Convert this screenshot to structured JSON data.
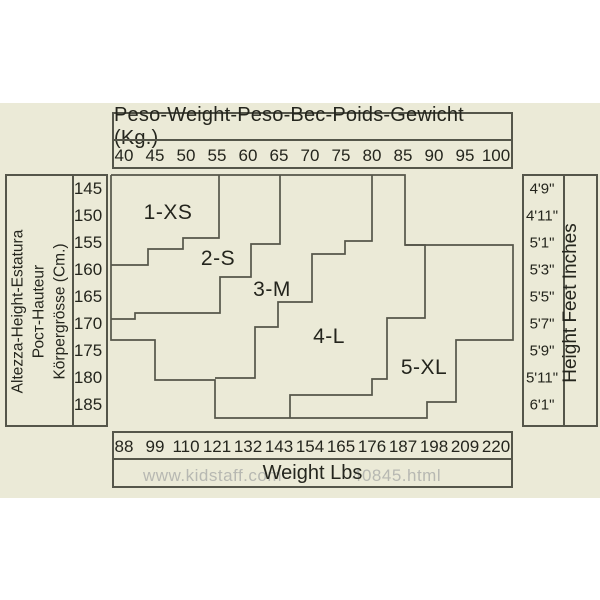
{
  "colors": {
    "page_background": "#ffffff",
    "panel_background": "#ebead7",
    "line": "#55564a",
    "text": "#24251d",
    "watermark": "#b7b8b2"
  },
  "kg_axis": {
    "title": "Peso-Weight-Peso-Вес-Poids-Gewicht (Kg.)",
    "ticks": [
      "40",
      "45",
      "50",
      "55",
      "60",
      "65",
      "70",
      "75",
      "80",
      "85",
      "90",
      "95",
      "100"
    ]
  },
  "lbs_axis": {
    "title": "Weight Lbs",
    "ticks": [
      "88",
      "99",
      "110",
      "121",
      "132",
      "143",
      "154",
      "165",
      "176",
      "187",
      "198",
      "209",
      "220"
    ]
  },
  "cm_axis": {
    "title_lines": [
      "Altezza-Height-Estatura",
      "Рост-Hauteur",
      "Körpergrösse (Cm.)"
    ],
    "ticks": [
      "145",
      "150",
      "155",
      "160",
      "165",
      "170",
      "175",
      "180",
      "185"
    ]
  },
  "ft_axis": {
    "title": "Height Feet Inches",
    "ticks": [
      "4'9\"",
      "4'11\"",
      "5'1\"",
      "5'3\"",
      "5'5\"",
      "5'7\"",
      "5'9\"",
      "5'11\"",
      "6'1\""
    ]
  },
  "zones": [
    {
      "label": "1-XS",
      "x": 168,
      "y": 213
    },
    {
      "label": "2-S",
      "x": 218,
      "y": 259
    },
    {
      "label": "3-M",
      "x": 272,
      "y": 290
    },
    {
      "label": "4-L",
      "x": 329,
      "y": 337
    },
    {
      "label": "5-XL",
      "x": 424,
      "y": 368
    }
  ],
  "watermark": {
    "left_fragment": "www.kidstaff.com",
    "right_fragment": "40845.html"
  },
  "geometry": {
    "tick_x": [
      122,
      153,
      184,
      215,
      246,
      277,
      308,
      339,
      370,
      401,
      432,
      463,
      494
    ],
    "row_y": [
      189,
      216,
      243,
      270,
      297,
      324,
      351,
      378,
      405
    ],
    "outer": [
      [
        111,
        175
      ],
      [
        405,
        175
      ],
      [
        405,
        245
      ],
      [
        513,
        245
      ],
      [
        513,
        340
      ],
      [
        456,
        340
      ],
      [
        456,
        402
      ],
      [
        427,
        402
      ],
      [
        427,
        418
      ],
      [
        215,
        418
      ],
      [
        215,
        380
      ],
      [
        155,
        380
      ],
      [
        155,
        340
      ],
      [
        111,
        340
      ],
      [
        111,
        175
      ]
    ],
    "boundaries": [
      [
        [
          219,
          175
        ],
        [
          219,
          238
        ],
        [
          183,
          238
        ],
        [
          183,
          249
        ],
        [
          148,
          249
        ],
        [
          148,
          265
        ],
        [
          111,
          265
        ]
      ],
      [
        [
          280,
          175
        ],
        [
          280,
          244
        ],
        [
          251,
          244
        ],
        [
          251,
          277
        ],
        [
          220,
          277
        ],
        [
          220,
          313
        ],
        [
          135,
          313
        ],
        [
          135,
          319
        ],
        [
          111,
          319
        ]
      ],
      [
        [
          372,
          175
        ],
        [
          372,
          241
        ],
        [
          345,
          241
        ],
        [
          345,
          254
        ],
        [
          312,
          254
        ],
        [
          312,
          302
        ],
        [
          278,
          302
        ],
        [
          278,
          327
        ],
        [
          255,
          327
        ],
        [
          255,
          378
        ],
        [
          215,
          378
        ]
      ],
      [
        [
          405,
          245
        ],
        [
          425,
          245
        ],
        [
          425,
          318
        ],
        [
          387,
          318
        ],
        [
          387,
          379
        ],
        [
          372,
          379
        ],
        [
          372,
          395
        ],
        [
          290,
          395
        ],
        [
          290,
          418
        ]
      ]
    ]
  },
  "chart_data": {
    "type": "heatmap",
    "title": "Peso-Weight-Peso-Вес-Poids-Gewicht (Kg.)",
    "xlabel_top": "Weight (Kg.)",
    "xlabel_bottom": "Weight Lbs",
    "ylabel_left": "Altezza-Height-Estatura Рост-Hauteur Körpergrösse (Cm.)",
    "ylabel_right": "Height Feet Inches",
    "x_kg": [
      40,
      45,
      50,
      55,
      60,
      65,
      70,
      75,
      80,
      85,
      90,
      95,
      100
    ],
    "x_lbs": [
      88,
      99,
      110,
      121,
      132,
      143,
      154,
      165,
      176,
      187,
      198,
      209,
      220
    ],
    "y_cm": [
      145,
      150,
      155,
      160,
      165,
      170,
      175,
      180,
      185
    ],
    "y_ft": [
      "4'9\"",
      "4'11\"",
      "5'1\"",
      "5'3\"",
      "5'5\"",
      "5'7\"",
      "5'9\"",
      "5'11\"",
      "6'1\""
    ],
    "legend_entries": [
      "1-XS",
      "2-S",
      "3-M",
      "4-L",
      "5-XL"
    ],
    "grid": false,
    "zone_kg_ranges_by_height_cm": {
      "145": {
        "1-XS": [
          40,
          55
        ],
        "2-S": [
          55,
          65
        ],
        "3-M": [
          65,
          80
        ],
        "4-L": [
          80,
          85
        ]
      },
      "150": {
        "1-XS": [
          40,
          55
        ],
        "2-S": [
          55,
          65
        ],
        "3-M": [
          65,
          80
        ],
        "4-L": [
          80,
          85
        ]
      },
      "155": {
        "1-XS": [
          40,
          50
        ],
        "2-S": [
          50,
          61
        ],
        "3-M": [
          61,
          76
        ],
        "4-L": [
          76,
          89
        ],
        "5-XL": [
          89,
          100
        ]
      },
      "160": {
        "2-S": [
          40,
          61
        ],
        "3-M": [
          61,
          71
        ],
        "4-L": [
          71,
          89
        ],
        "5-XL": [
          89,
          100
        ]
      },
      "165": {
        "2-S": [
          40,
          56
        ],
        "3-M": [
          56,
          71
        ],
        "4-L": [
          71,
          89
        ],
        "5-XL": [
          89,
          100
        ]
      },
      "170": {
        "3-M": [
          42,
          65
        ],
        "4-L": [
          65,
          83
        ],
        "5-XL": [
          83,
          100
        ]
      },
      "175": {
        "3-M": [
          45,
          62
        ],
        "4-L": [
          62,
          83
        ],
        "5-XL": [
          83,
          94
        ]
      },
      "180": {
        "4-L": [
          55,
          80
        ],
        "5-XL": [
          80,
          94
        ]
      },
      "185": {
        "4-L": [
          55,
          67
        ],
        "5-XL": [
          67,
          89
        ]
      }
    }
  }
}
